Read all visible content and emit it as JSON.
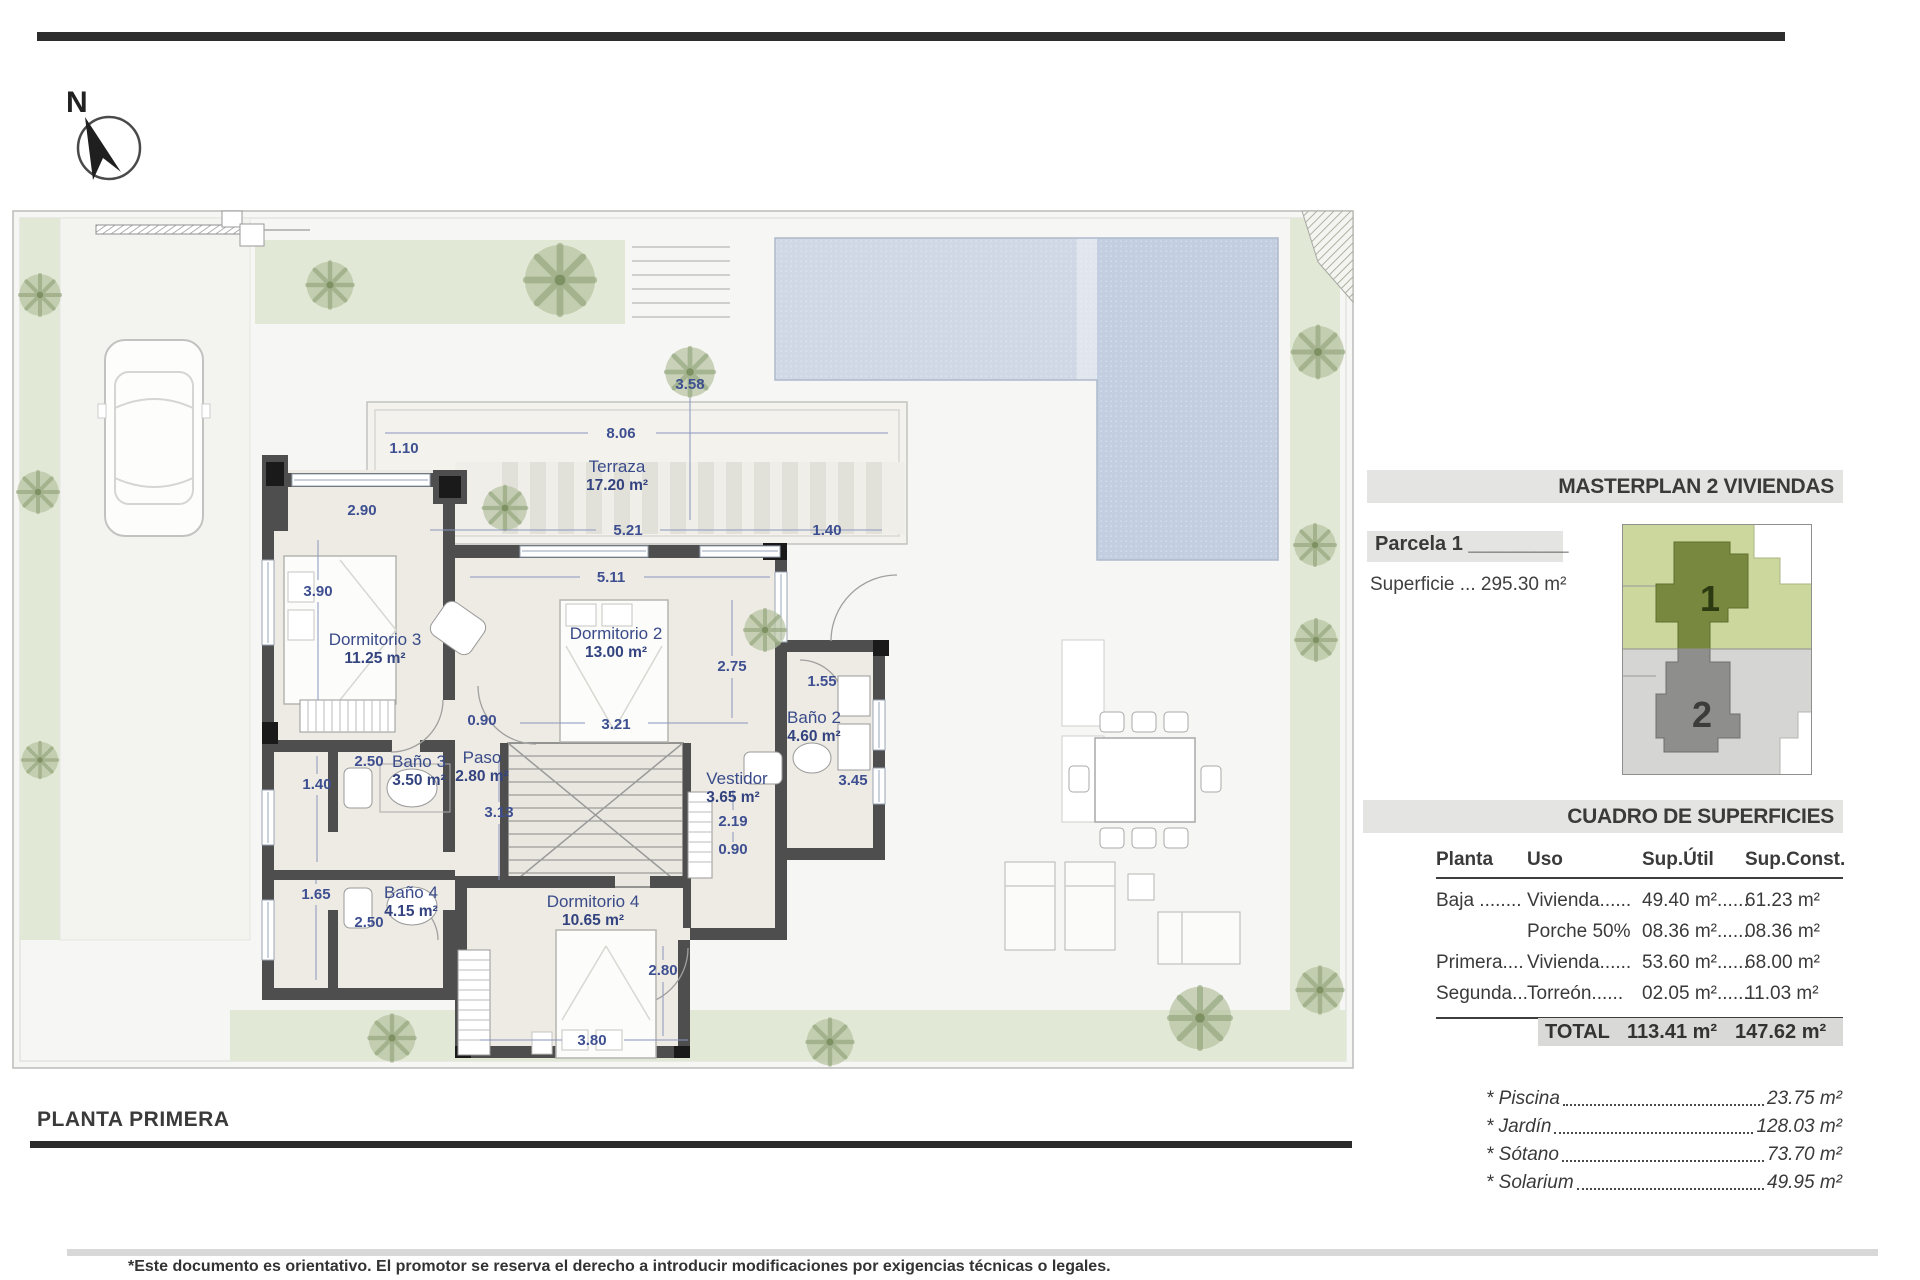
{
  "compass": {
    "label": "N"
  },
  "masterplan": {
    "title": "MASTERPLAN 2 VIVIENDAS",
    "parcel_label": "Parcela 1",
    "parcel_underscore": "_________",
    "superficie": "Superficie ... 295.30 m²",
    "parcel1_num": "1",
    "parcel2_num": "2"
  },
  "surfaces": {
    "title": "CUADRO DE SUPERFICIES",
    "columns": [
      "Planta",
      "Uso",
      "Sup.Útil",
      "Sup.Const."
    ],
    "rows": [
      {
        "planta": "Baja ........",
        "uso": "Vivienda......",
        "util": "49.40 m²......",
        "const": "61.23 m²"
      },
      {
        "planta": "",
        "uso": "Porche 50%",
        "util": "08.36 m²......",
        "const": "08.36 m²"
      },
      {
        "planta": "Primera....",
        "uso": "Vivienda......",
        "util": "53.60 m²......",
        "const": "68.00 m²"
      },
      {
        "planta": "Segunda...",
        "uso": "Torreón......",
        "util": "02.05 m²......",
        "const": "11.03 m²"
      }
    ],
    "total_label": "TOTAL",
    "total_util": "113.41 m²",
    "total_const": "147.62 m²"
  },
  "extras": [
    {
      "name": "* Piscina",
      "value": "23.75 m²"
    },
    {
      "name": "* Jardín",
      "value": "128.03 m²"
    },
    {
      "name": "* Sótano",
      "value": "73.70 m²"
    },
    {
      "name": "* Solarium",
      "value": "49.95 m²"
    }
  ],
  "rooms": [
    {
      "name": "Terraza",
      "area": "17.20 m²"
    },
    {
      "name": "Dormitorio 3",
      "area": "11.25 m²"
    },
    {
      "name": "Dormitorio 2",
      "area": "13.00 m²"
    },
    {
      "name": "Baño 2",
      "area": "4.60 m²"
    },
    {
      "name": "Baño 3",
      "area": "3.50 m²"
    },
    {
      "name": "Paso",
      "area": "2.80 m²"
    },
    {
      "name": "Vestidor",
      "area": "3.65 m²"
    },
    {
      "name": "Baño 4",
      "area": "4.15 m²"
    },
    {
      "name": "Dormitorio 4",
      "area": "10.65 m²"
    }
  ],
  "dimensions": [
    "8.06",
    "1.10",
    "3.58",
    "2.90",
    "5.21",
    "1.40",
    "3.90",
    "5.11",
    "2.75",
    "1.55",
    "0.90",
    "3.21",
    "2.50",
    "1.40",
    "3.45",
    "3.13",
    "2.19",
    "0.90",
    "1.65",
    "2.50",
    "2.80",
    "3.80"
  ],
  "plan_title": {
    "label": "PLANTA PRIMERA"
  },
  "footer": {
    "disclaimer": "*Este documento es orientativo. El promotor se reserva el derecho a introducir modificaciones por exigencias técnicas o legales."
  }
}
